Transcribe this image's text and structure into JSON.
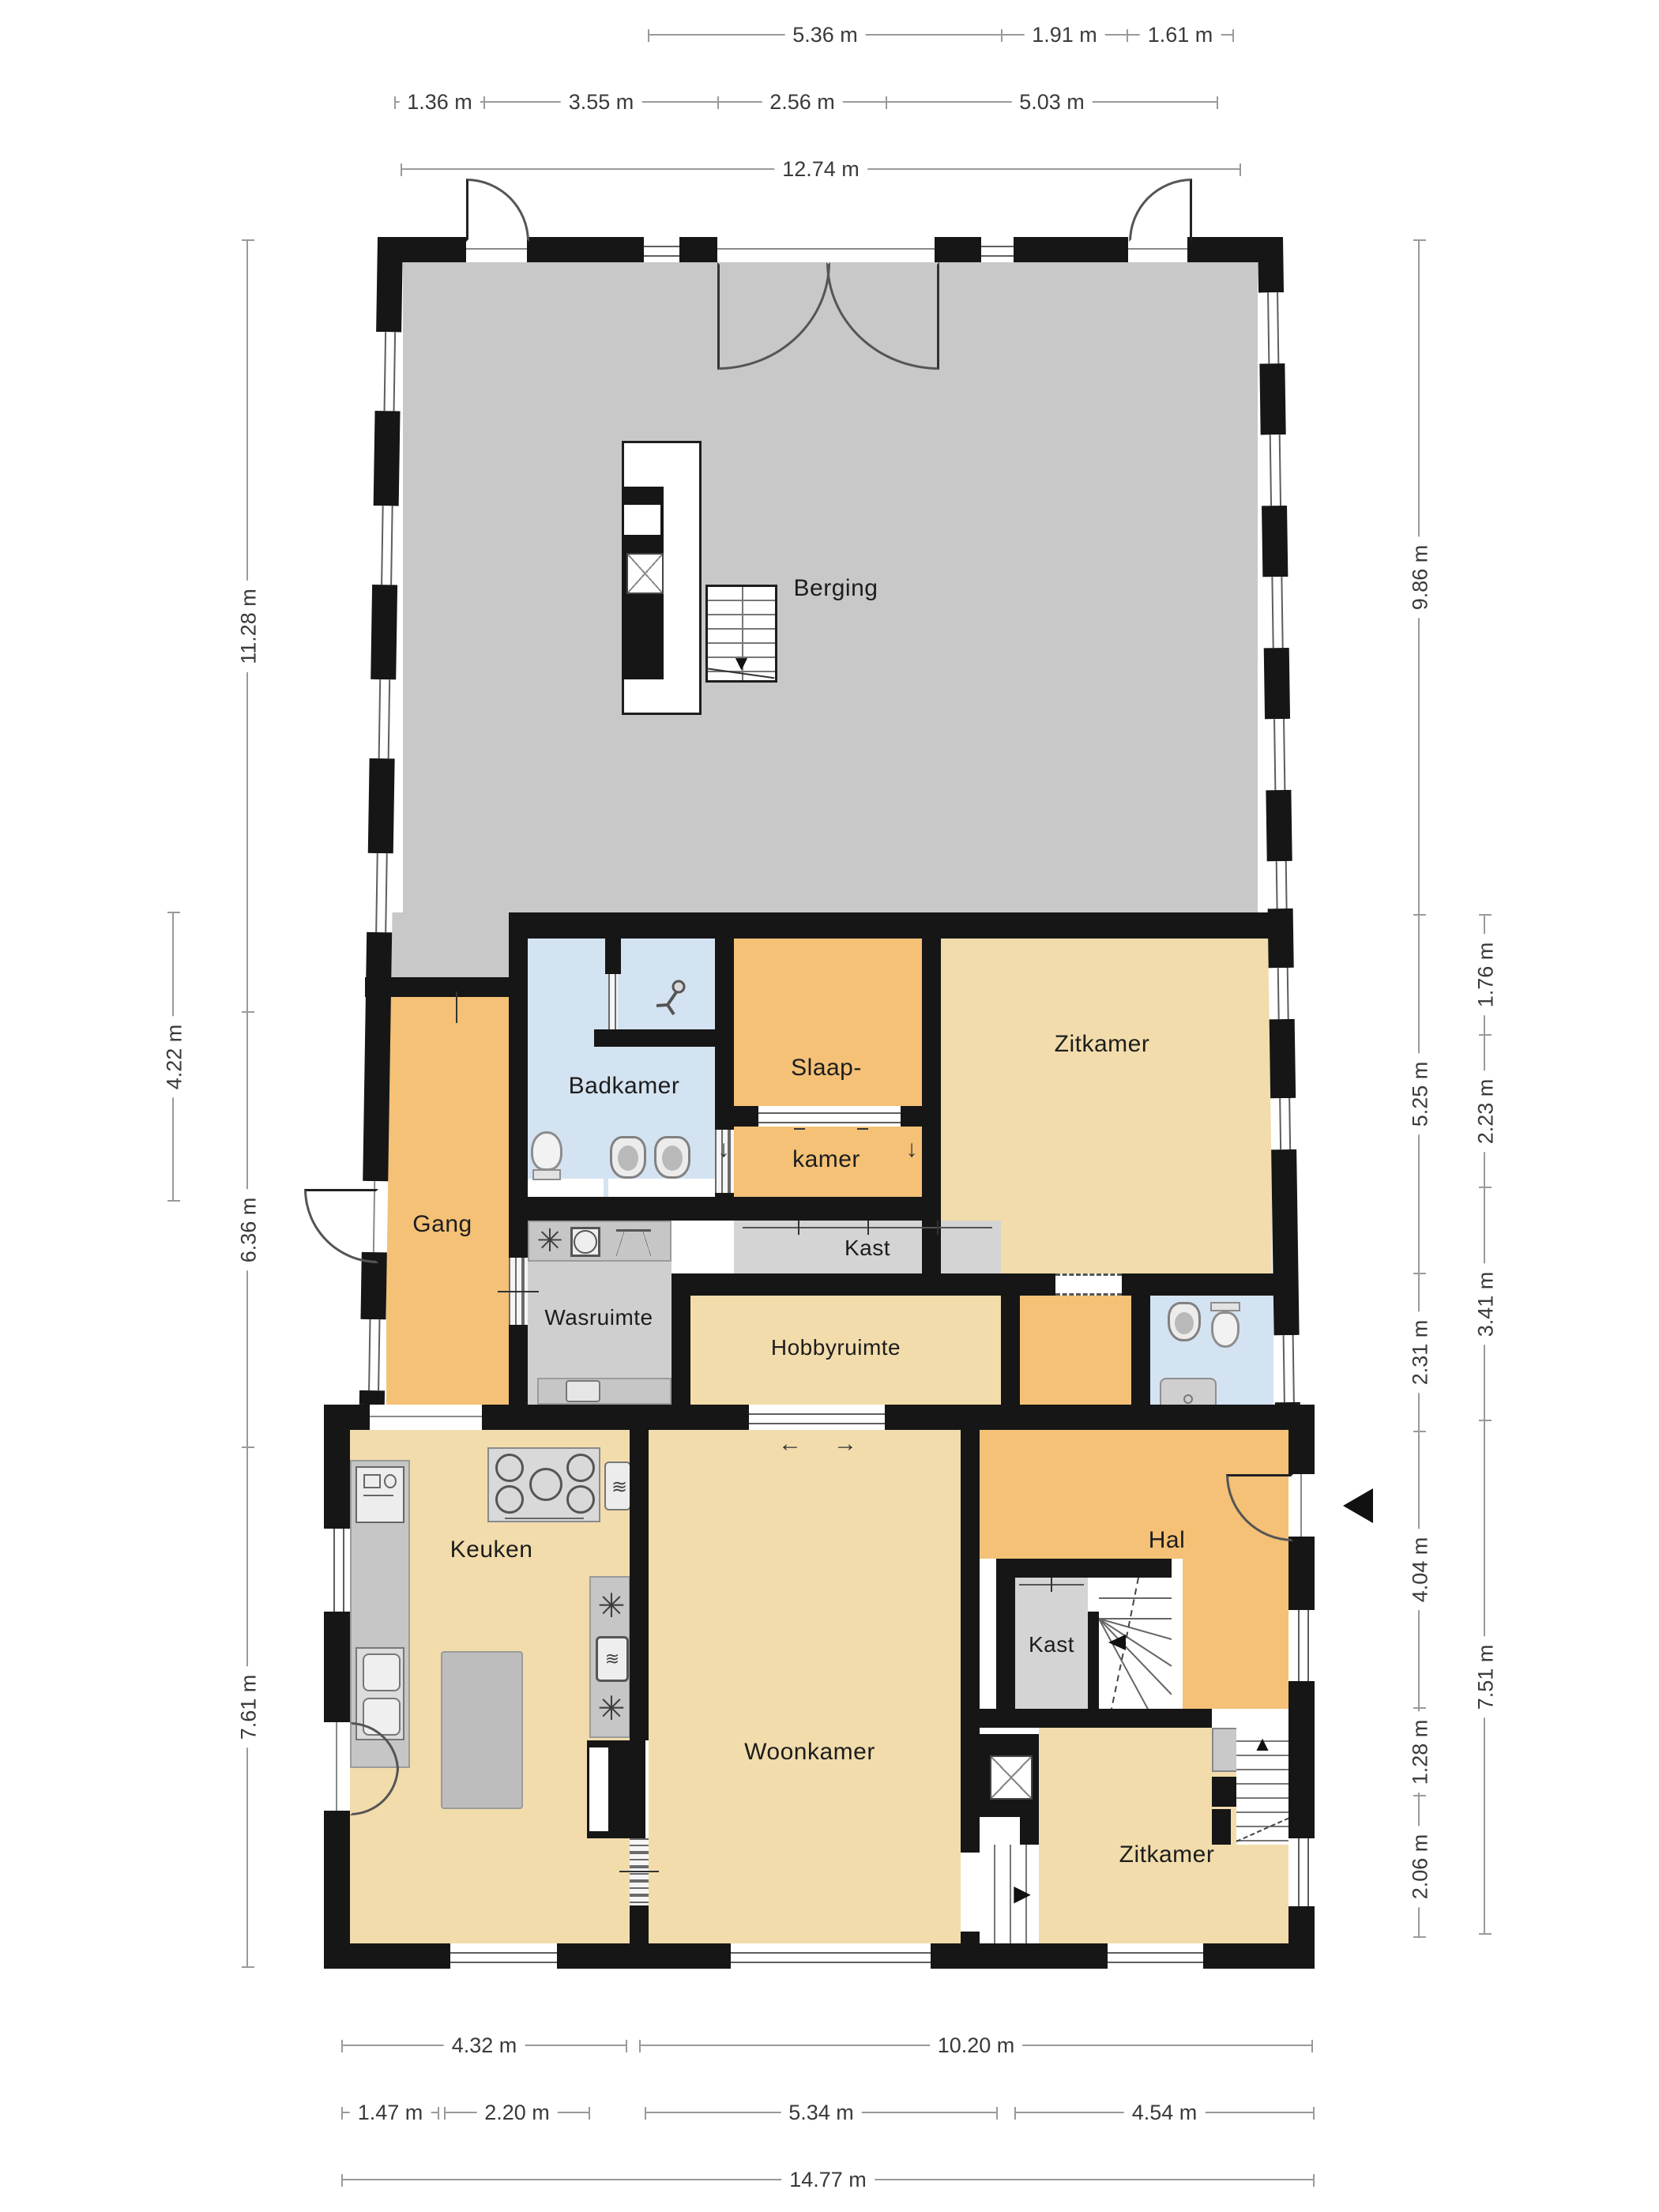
{
  "rooms": {
    "berging": "Berging",
    "badkamer": "Badkamer",
    "slaapkamer_line1": "Slaap-",
    "slaapkamer_line2": "kamer",
    "zitkamer_mid": "Zitkamer",
    "kast_mid": "Kast",
    "gang": "Gang",
    "wasruimte": "Wasruimte",
    "hobbyruimte": "Hobbyruimte",
    "keuken": "Keuken",
    "hal": "Hal",
    "kast_hal": "Kast",
    "woonkamer": "Woonkamer",
    "zitkamer_bottom": "Zitkamer"
  },
  "dimensions": {
    "top_row1": [
      "5.36 m",
      "1.91 m",
      "1.61 m"
    ],
    "top_row2": [
      "1.36 m",
      "3.55 m",
      "2.56 m",
      "5.03 m"
    ],
    "top_total": "12.74 m",
    "left_inner": [
      "11.28 m",
      "6.36 m",
      "7.61 m"
    ],
    "left_outer": [
      "4.22 m"
    ],
    "right_inner": [
      "9.86 m",
      "5.25 m",
      "2.31 m",
      "4.04 m",
      "1.28 m",
      "2.06 m"
    ],
    "right_outer": [
      "1.76 m",
      "2.23 m",
      "3.41 m",
      "7.51 m"
    ],
    "bottom_row1": [
      "4.32 m",
      "10.20 m"
    ],
    "bottom_row2": [
      "1.47 m",
      "2.20 m",
      "5.34 m",
      "4.54 m"
    ],
    "bottom_total": "14.77 m"
  },
  "glyphs": {
    "fan": "✳",
    "waves": "≋",
    "arrow_down": "▼",
    "arrow_up": "▲",
    "arrow_right": "▶",
    "down_small": "↓",
    "slide_left": "←",
    "slide_right": "→"
  },
  "colors": {
    "wall": "#161616",
    "storage_gray": "#c8c8c8",
    "living_tan": "#f2dcab",
    "circulation_orange": "#f4c177",
    "sanitary_blue": "#d4e3f2",
    "closet_gray": "#d4d4d4",
    "laundry_gray": "#cfcfcf"
  }
}
